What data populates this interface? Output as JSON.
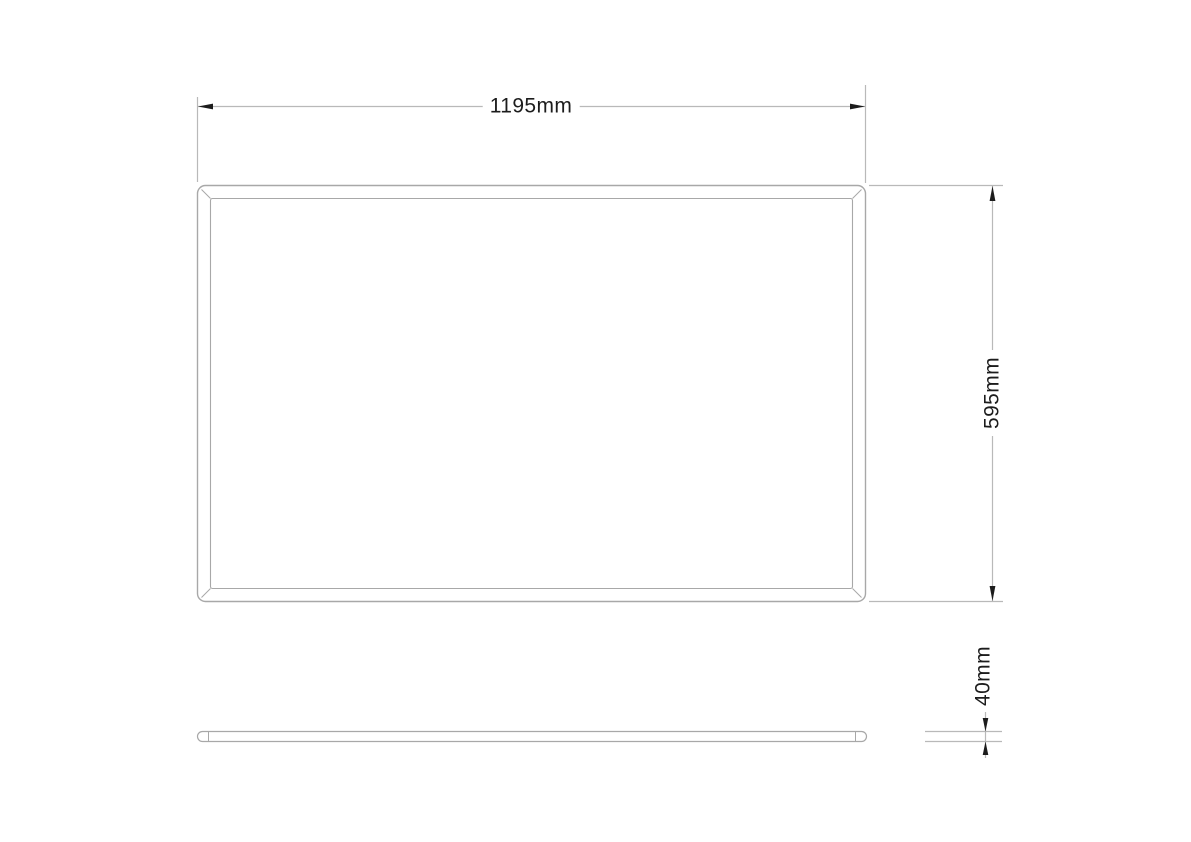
{
  "title": "Panel dimension drawing",
  "drawing": {
    "dimensions": {
      "width": {
        "label": "1195mm",
        "value_mm": 1195
      },
      "height": {
        "label": "595mm",
        "value_mm": 595
      },
      "depth": {
        "label": "40mm",
        "value_mm": 40
      }
    },
    "colors": {
      "ink": "#1c1c1c",
      "line": "#b9b9b9",
      "panel_line": "#a8a8a8",
      "background": "#ffffff"
    }
  }
}
